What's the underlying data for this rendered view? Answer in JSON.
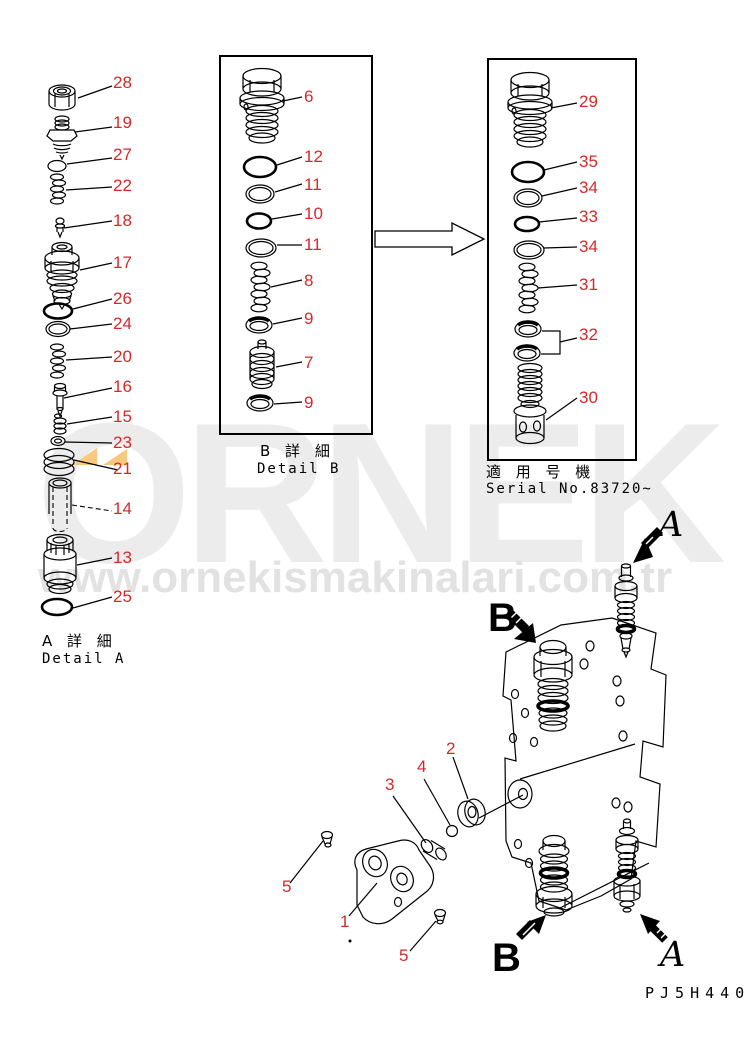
{
  "page": {
    "drawing_code": "PJ5H440"
  },
  "colors": {
    "label_red": "#d42a2a",
    "line_black": "#000000",
    "watermark_grey": "#ececec",
    "watermark_url_grey": "#e2e2e2",
    "watermark_triangle_orange": "#f8c87e"
  },
  "watermark": {
    "brand": "ORNEK",
    "url": "www.ornekismakinalari.com.tr"
  },
  "detail_a": {
    "caption_local": "A 詳 細",
    "caption_en": "Detail A",
    "labels": [
      "28",
      "19",
      "27",
      "22",
      "18",
      "17",
      "26",
      "24",
      "20",
      "16",
      "15",
      "23",
      "21",
      "14",
      "13",
      "25"
    ]
  },
  "detail_b": {
    "caption_local": "B 詳 細",
    "caption_en": "Detail B",
    "labels": [
      "6",
      "12",
      "11",
      "10",
      "11",
      "8",
      "9",
      "7",
      "9"
    ]
  },
  "serial_section": {
    "caption_local": "適 用 号 機",
    "caption_en": "Serial No.83720~",
    "labels": [
      "29",
      "35",
      "34",
      "33",
      "34",
      "31",
      "32",
      "30"
    ]
  },
  "assembly": {
    "labels": {
      "part_2": "2",
      "part_4": "4",
      "part_3": "3",
      "part_5_left": "5",
      "part_1": "1",
      "part_5_right": "5"
    },
    "view_b_top": "B",
    "view_a_top": "A",
    "view_b_bottom": "B",
    "view_a_bottom": "A"
  }
}
